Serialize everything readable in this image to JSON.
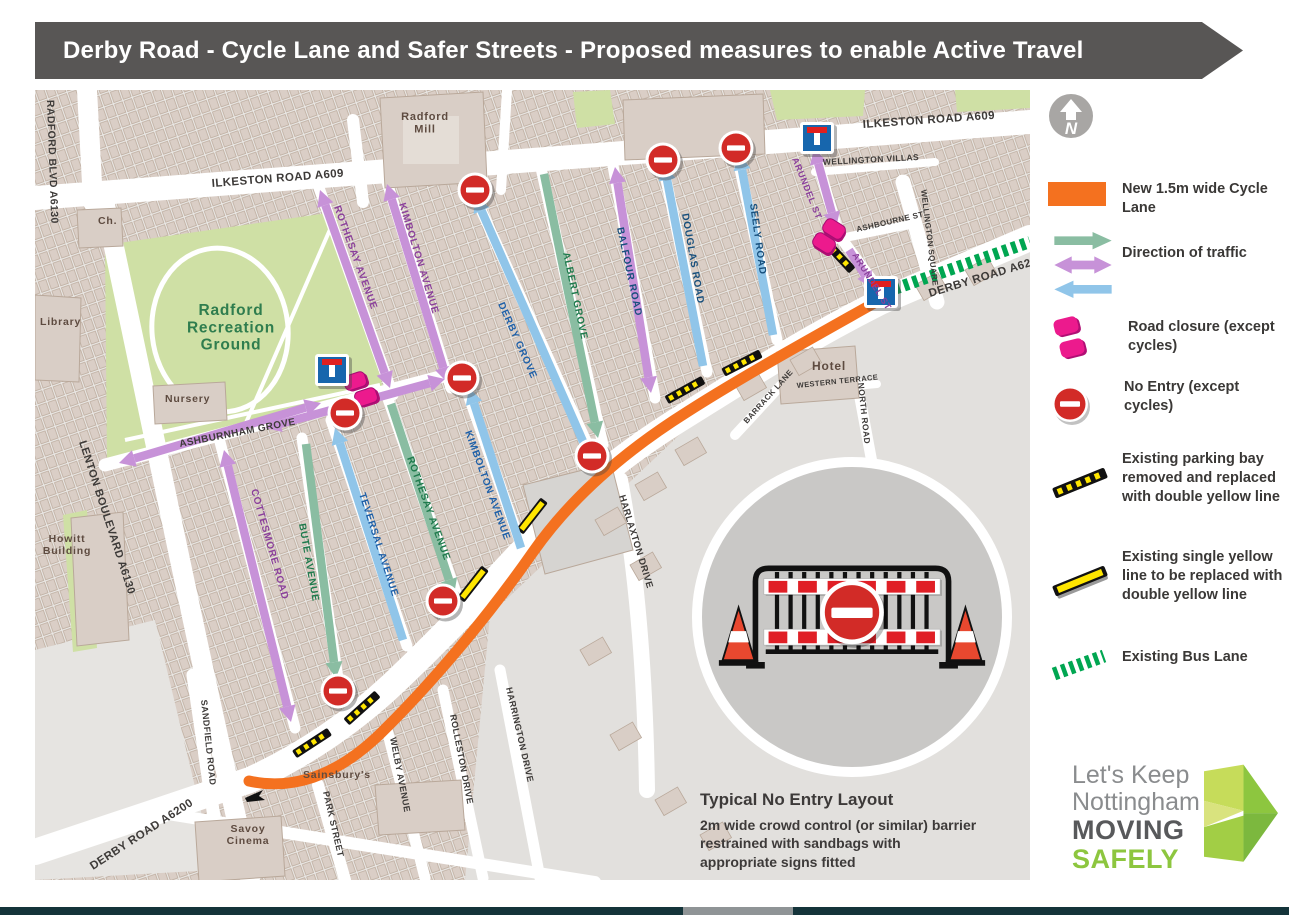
{
  "header": {
    "title": "Derby Road - Cycle Lane and Safer Streets - Proposed measures to enable Active Travel"
  },
  "compass": {
    "letter": "N"
  },
  "legend": {
    "items": [
      {
        "id": "cycle-lane",
        "label": "New 1.5m wide Cycle Lane"
      },
      {
        "id": "direction",
        "label": "Direction of traffic"
      },
      {
        "id": "road-closure",
        "label": "Road closure (except cycles)"
      },
      {
        "id": "no-entry",
        "label": "No Entry (except cycles)"
      },
      {
        "id": "parking-bay",
        "label": "Existing parking bay removed and replaced with double yellow line"
      },
      {
        "id": "single-yellow",
        "label": "Existing single yellow line to be replaced with double yellow line"
      },
      {
        "id": "bus-lane",
        "label": "Existing Bus Lane"
      }
    ]
  },
  "inset": {
    "title": "Typical No Entry Layout",
    "body": "2m wide crowd control (or similar) barrier restrained with sandbags with appropriate signs fitted"
  },
  "logo": {
    "line1": "Let's Keep",
    "line2": "Nottingham",
    "line3": "MOVING",
    "line4": "SAFELY"
  },
  "map": {
    "labels": [
      "ILKESTON ROAD A609",
      "ILKESTON ROAD A609",
      "RADFORD BLVD A6130",
      "LENTON BOULEVARD A6130",
      "DERBY ROAD A6200",
      "DERBY ROAD A6200",
      "ASHBURNHAM GROVE",
      "WELLINGTON VILLAS",
      "ASHBOURNE ST",
      "WELLINGTON SQUARE",
      "NORTH ROAD",
      "WESTERN TERRACE",
      "BARRACK LANE",
      "SANDFIELD ROAD",
      "PARK STREET",
      "WELBY AVENUE",
      "ROLLESTON DRIVE",
      "HARRINGTON DRIVE",
      "HARLAXTON DRIVE",
      "Radford\nMill",
      "Ch.",
      "Library",
      "Radford\nRecreation\nGround",
      "Nursery",
      "Howitt\nBuilding",
      "Hotel",
      "Sainsbury's",
      "Savoy\nCinema",
      "ROTHESAY AVENUE",
      "KIMBOLTON AVENUE",
      "DERBY GROVE",
      "ALBERT GROVE",
      "BALFOUR ROAD",
      "DOUGLAS ROAD",
      "SEELY ROAD",
      "ARUNDEL ST",
      "ARUNDEL ST",
      "COTTESMORE ROAD",
      "BUTE AVENUE",
      "TEVERSAL AVENUE",
      "ROTHESAY AVENUE",
      "KIMBOLTON AVENUE"
    ]
  },
  "colors": {
    "header_bg": "#585655",
    "cycle_lane_orange": "#f4711f",
    "arrow_purple": "#c792d8",
    "arrow_green": "#8abda2",
    "arrow_blue": "#90c5e9",
    "closure_pink": "#ec1a8d",
    "no_entry_red": "#d22b27",
    "bus_lane_green": "#00a651",
    "yellow_line": "#ffe600",
    "park_green": "#cfe0a5",
    "logo_green": "#8dc63f"
  }
}
